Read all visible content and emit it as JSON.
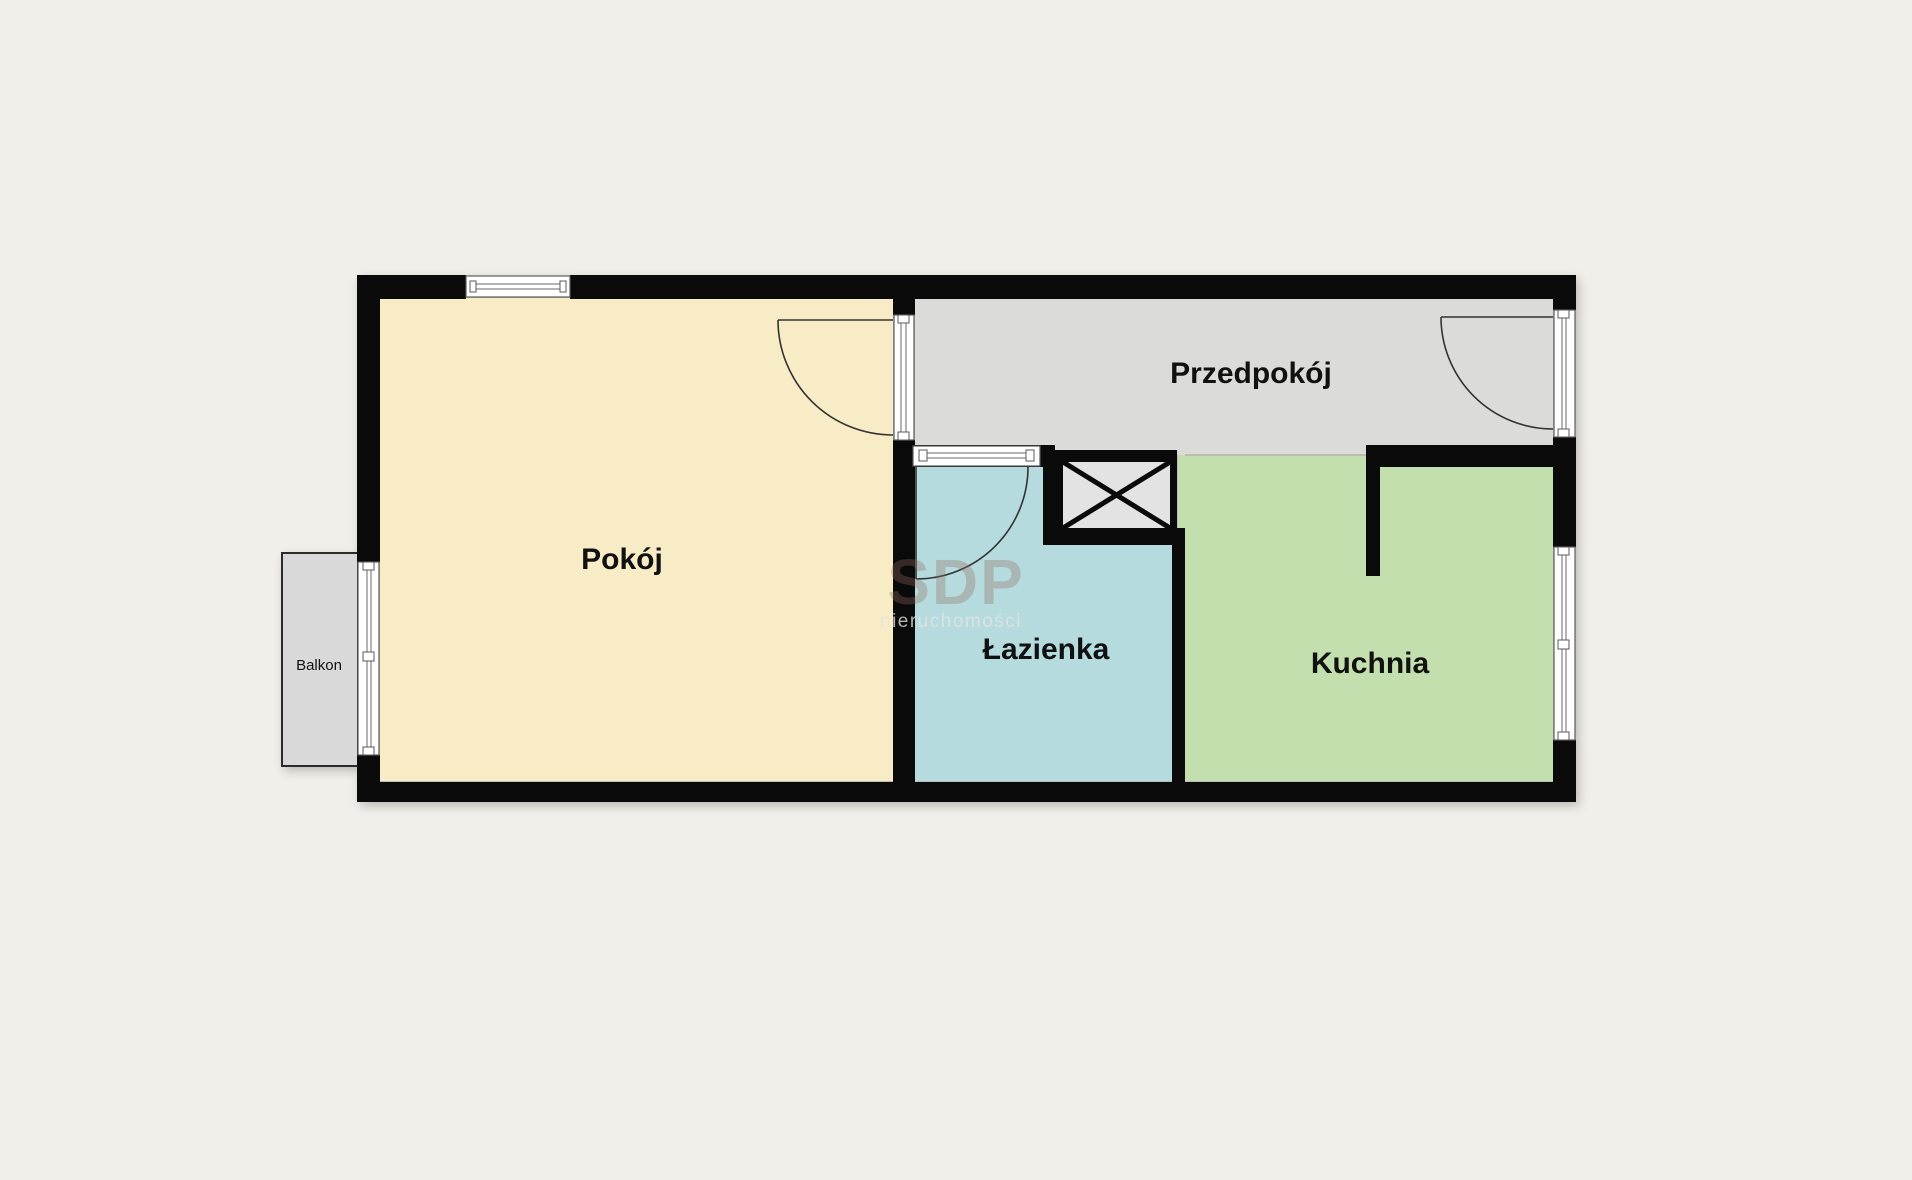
{
  "page": {
    "background": "#f0efe9"
  },
  "plan": {
    "wall_color": "#0a0a0a",
    "rooms": [
      {
        "id": "pokoj",
        "label": "Pokój",
        "color": "#f7ecc5"
      },
      {
        "id": "przedpokoj",
        "label": "Przedpokój",
        "color": "#dbdbda"
      },
      {
        "id": "lazienka",
        "label": "Łazienka",
        "color": "#b5dbdf"
      },
      {
        "id": "kuchnia",
        "label": "Kuchnia",
        "color": "#c4dfae"
      },
      {
        "id": "balkon",
        "label": "Balkon",
        "color": "#d9d9d9"
      }
    ],
    "shaft": {
      "fill": "#e3e3e3"
    },
    "watermark": {
      "title": "SDP",
      "subtitle": "nieruchomości"
    }
  }
}
